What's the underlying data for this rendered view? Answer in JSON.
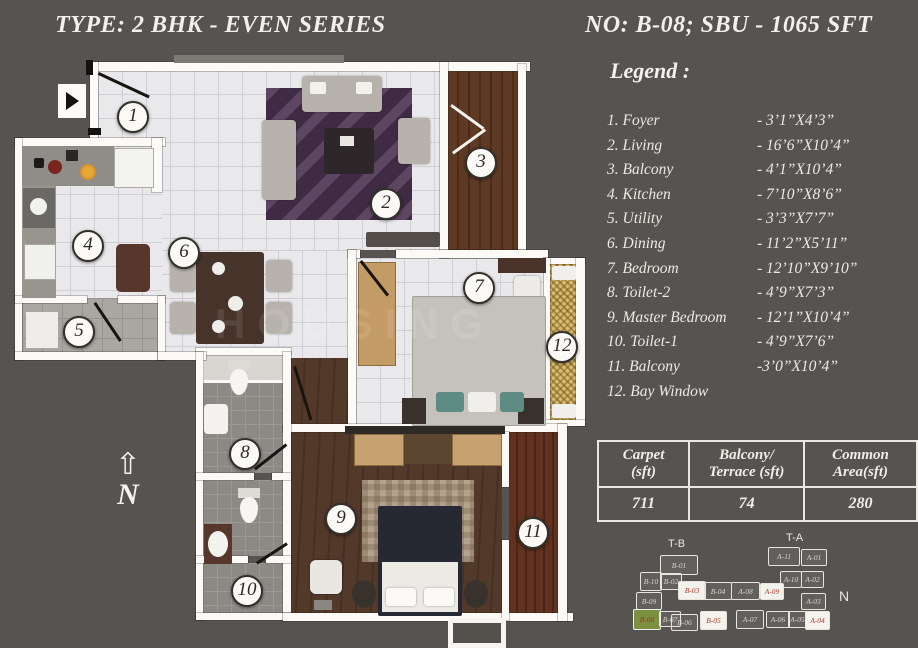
{
  "header": {
    "left_title": "TYPE: 2 BHK - EVEN SERIES",
    "right_title": "NO: B-08; SBU - 1065 SFT"
  },
  "legend": {
    "heading": "Legend :",
    "items": [
      {
        "num": "1",
        "label": "1. Foyer",
        "dim": "- 3’1”X4’3”"
      },
      {
        "num": "2",
        "label": "2. Living",
        "dim": "- 16’6”X10’4”"
      },
      {
        "num": "3",
        "label": "3. Balcony",
        "dim": "- 4’1”X10’4”"
      },
      {
        "num": "4",
        "label": "4. Kitchen",
        "dim": "- 7’10”X8’6”"
      },
      {
        "num": "5",
        "label": "5. Utility",
        "dim": "- 3’3”X7’7”"
      },
      {
        "num": "6",
        "label": "6. Dining",
        "dim": "- 11’2”X5’11”"
      },
      {
        "num": "7",
        "label": "7. Bedroom",
        "dim": "- 12’10”X9’10”"
      },
      {
        "num": "8",
        "label": "8. Toilet-2",
        "dim": "- 4’9”X7’3”"
      },
      {
        "num": "9",
        "label": "9. Master Bedroom",
        "dim": "- 12’1”X10’4”"
      },
      {
        "num": "10",
        "label": "10. Toilet-1",
        "dim": "- 4’9”X7’6”"
      },
      {
        "num": "11",
        "label": "11. Balcony",
        "dim": "-3’0”X10’4”"
      },
      {
        "num": "12",
        "label": "12. Bay Window",
        "dim": ""
      }
    ]
  },
  "plan": {
    "badges": [
      {
        "num": "1",
        "cx": 133,
        "cy": 117
      },
      {
        "num": "2",
        "cx": 386,
        "cy": 204
      },
      {
        "num": "3",
        "cx": 481,
        "cy": 163
      },
      {
        "num": "4",
        "cx": 88,
        "cy": 246
      },
      {
        "num": "5",
        "cx": 79,
        "cy": 332
      },
      {
        "num": "6",
        "cx": 184,
        "cy": 253
      },
      {
        "num": "7",
        "cx": 479,
        "cy": 288
      },
      {
        "num": "8",
        "cx": 245,
        "cy": 454
      },
      {
        "num": "9",
        "cx": 341,
        "cy": 519
      },
      {
        "num": "10",
        "cx": 247,
        "cy": 591
      },
      {
        "num": "11",
        "cx": 533,
        "cy": 533
      },
      {
        "num": "12",
        "cx": 562,
        "cy": 347
      }
    ]
  },
  "compass": {
    "letter": "N",
    "arrow": "⇧"
  },
  "watermark": "HOUSING",
  "area_table": {
    "headers": [
      "Carpet\n(sft)",
      "Balcony/\nTerrace (sft)",
      "Common\nArea(sft)"
    ],
    "values": [
      "711",
      "74",
      "280"
    ]
  },
  "sitemap": {
    "tower_left": "T-B",
    "tower_right": "T-A",
    "north": "N",
    "blocks": [
      {
        "label": "B-01",
        "x": 35,
        "y": 25,
        "w": 36,
        "h": 18,
        "variant": "normal"
      },
      {
        "label": "B-10",
        "x": 15,
        "y": 42,
        "w": 20,
        "h": 17,
        "variant": "normal"
      },
      {
        "label": "B-02",
        "x": 35,
        "y": 43,
        "w": 20,
        "h": 15,
        "variant": "normal"
      },
      {
        "label": "B-09",
        "x": 11,
        "y": 62,
        "w": 24,
        "h": 16,
        "variant": "normal"
      },
      {
        "label": "B-03",
        "x": 53,
        "y": 51,
        "w": 26,
        "h": 17,
        "variant": "active"
      },
      {
        "label": "B-04",
        "x": 79,
        "y": 52,
        "w": 26,
        "h": 16,
        "variant": "normal"
      },
      {
        "label": "A-08",
        "x": 106,
        "y": 52,
        "w": 27,
        "h": 16,
        "variant": "normal"
      },
      {
        "label": "B-08",
        "x": 8,
        "y": 79,
        "w": 26,
        "h": 19,
        "variant": "green"
      },
      {
        "label": "B-07",
        "x": 34,
        "y": 81,
        "w": 20,
        "h": 14,
        "variant": "normal"
      },
      {
        "label": "B-06",
        "x": 46,
        "y": 84,
        "w": 25,
        "h": 15,
        "variant": "normal"
      },
      {
        "label": "B-05",
        "x": 75,
        "y": 81,
        "w": 25,
        "h": 17,
        "variant": "active"
      },
      {
        "label": "A-07",
        "x": 111,
        "y": 80,
        "w": 26,
        "h": 17,
        "variant": "normal"
      },
      {
        "label": "A-11",
        "x": 143,
        "y": 17,
        "w": 30,
        "h": 17,
        "variant": "normal"
      },
      {
        "label": "A-01",
        "x": 176,
        "y": 19,
        "w": 24,
        "h": 15,
        "variant": "normal"
      },
      {
        "label": "A-10",
        "x": 155,
        "y": 41,
        "w": 20,
        "h": 15,
        "variant": "normal"
      },
      {
        "label": "A-02",
        "x": 176,
        "y": 41,
        "w": 21,
        "h": 15,
        "variant": "normal"
      },
      {
        "label": "A-09",
        "x": 135,
        "y": 53,
        "w": 22,
        "h": 15,
        "variant": "active"
      },
      {
        "label": "A-03",
        "x": 176,
        "y": 63,
        "w": 23,
        "h": 15,
        "variant": "normal"
      },
      {
        "label": "A-06",
        "x": 141,
        "y": 81,
        "w": 22,
        "h": 15,
        "variant": "normal"
      },
      {
        "label": "A-05",
        "x": 163,
        "y": 81,
        "w": 17,
        "h": 15,
        "variant": "normal"
      },
      {
        "label": "A-04",
        "x": 180,
        "y": 81,
        "w": 23,
        "h": 17,
        "variant": "active"
      }
    ]
  },
  "colors": {
    "background": "#575350",
    "wall": "#fbfaf6",
    "highlight_unit_green": "#7b9140",
    "unit_label_red": "#b23b2e",
    "balcony_wood": "#5e3a24",
    "bay_window": "#d9bd71"
  }
}
